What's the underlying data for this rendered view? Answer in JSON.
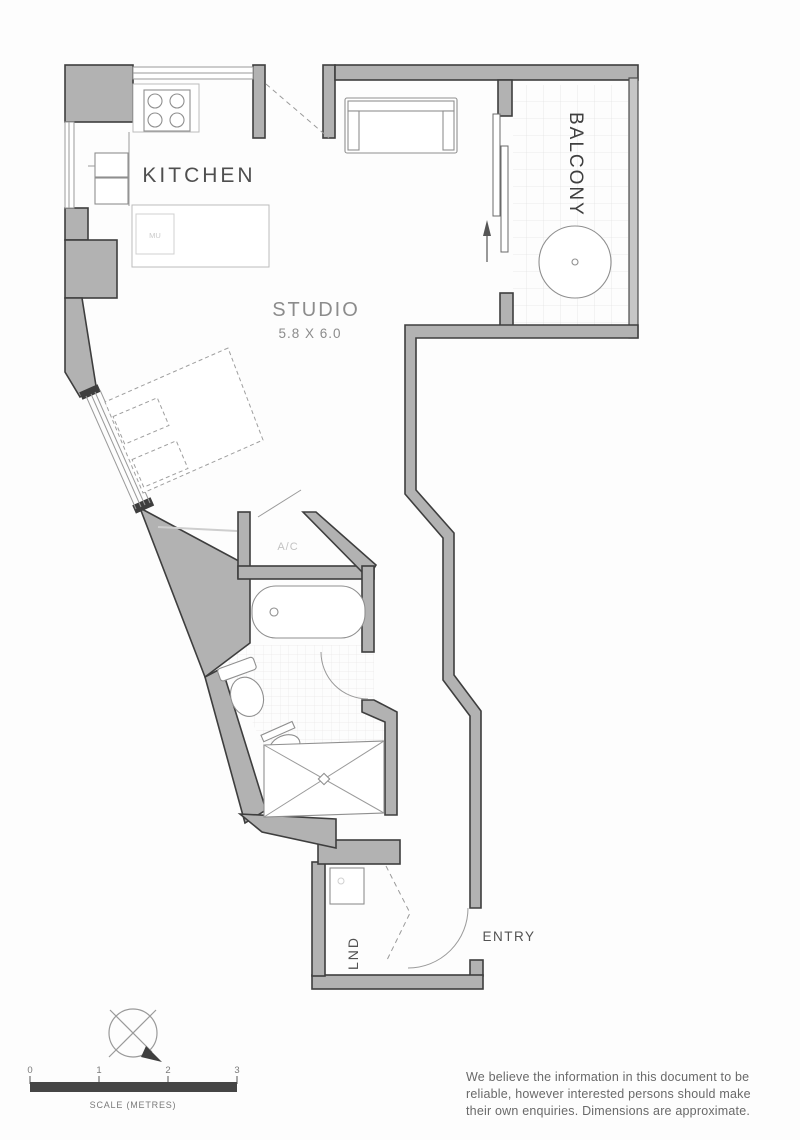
{
  "rooms": {
    "kitchen": "KITCHEN",
    "studio": "STUDIO",
    "studio_dimensions": "5.8 X 6.0",
    "balcony": "BALCONY",
    "ac_unit": "A/C",
    "laundry": "LND",
    "entry": "ENTRY",
    "microwave": "MU"
  },
  "scale": {
    "ticks": [
      "0",
      "1",
      "2",
      "3"
    ],
    "label": "SCALE (METRES)"
  },
  "disclaimer": {
    "line1": "We believe the information in this document to be",
    "line2": "reliable, however interested persons should make",
    "line3": "their own enquiries. Dimensions are approximate."
  },
  "icons": {
    "compass": "compass-rose"
  },
  "colors": {
    "wall_fill": "#b2b2b2",
    "wall_outline": "#3e3e3e",
    "balcony_wall": "#c6c6c6",
    "scale_bar": "#454545",
    "label_dark": "#4d4d4d",
    "label_light": "#8c8c8c",
    "label_faint": "#c2c2c2",
    "fixture_stroke": "#8f8f8f",
    "tile_line": "#e4e4e4"
  }
}
